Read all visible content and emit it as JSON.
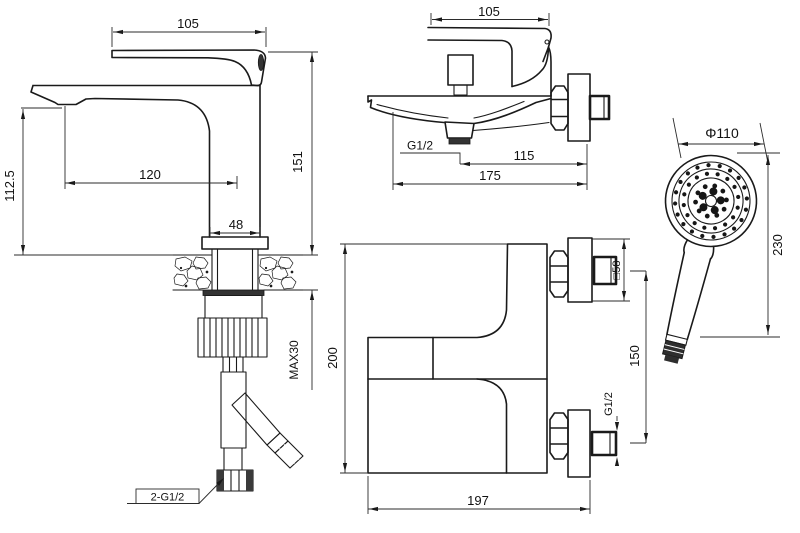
{
  "views": {
    "basin_mixer": {
      "dims": {
        "handle_width": "105",
        "height": "151",
        "spout_height": "112.5",
        "spout_reach": "120",
        "body_width": "48",
        "max_deck_thickness": "MAX30",
        "supply_hoses": "2-G1/2"
      }
    },
    "bath_mixer_side": {
      "dims": {
        "handle_width": "105",
        "spout_thread": "G1/2",
        "wall_distance": "115",
        "total_depth": "175"
      }
    },
    "bath_mixer_front": {
      "dims": {
        "height": "200",
        "width": "197",
        "inlet_spacing": "150",
        "flange_size": "□58",
        "inlet_thread": "G1/2"
      }
    },
    "hand_shower": {
      "dims": {
        "head_diameter": "Φ110",
        "length": "230"
      }
    }
  }
}
